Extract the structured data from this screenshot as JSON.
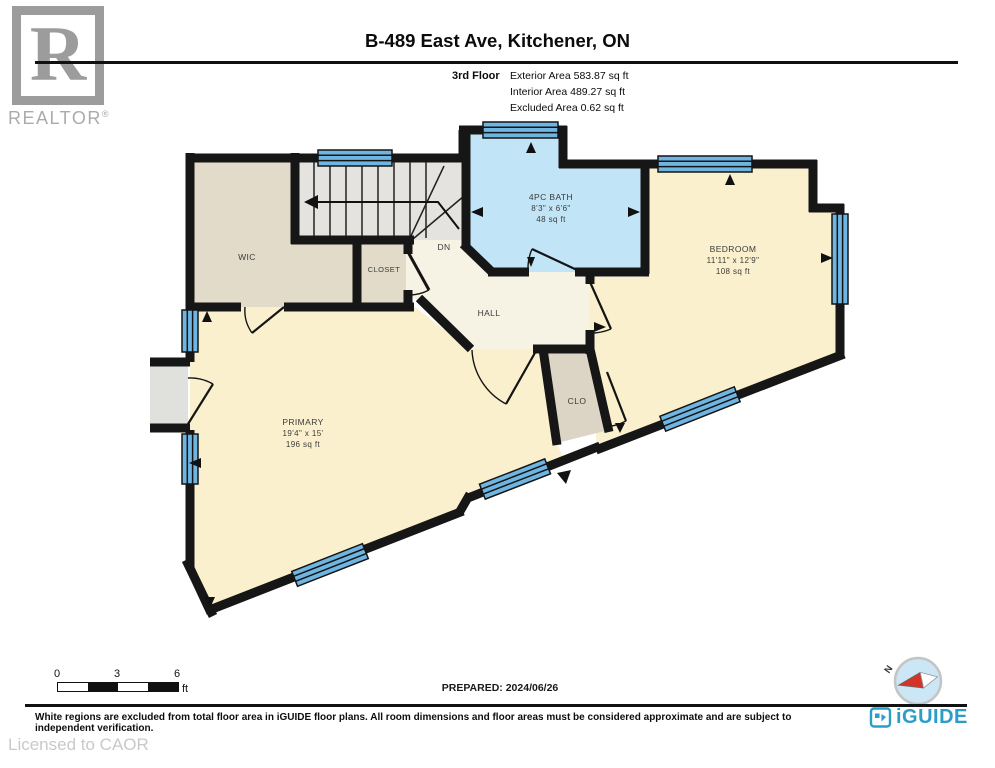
{
  "header": {
    "brand_logo": "R",
    "brand_name": "REALTOR",
    "brand_reg": "®",
    "title": "B-489 East Ave, Kitchener, ON",
    "floor_label": "3rd Floor",
    "area_lines": [
      "Exterior Area 583.87 sq ft",
      "Interior Area 489.27 sq ft",
      "Excluded Area 0.62 sq ft"
    ]
  },
  "plan": {
    "rooms": {
      "wic": {
        "name": "WIC"
      },
      "closet": {
        "name": "CLOSET"
      },
      "stairs": {
        "direction": "DN"
      },
      "bath": {
        "name": "4PC BATH",
        "dims": "8'3\" x 6'6\"",
        "area": "48 sq ft"
      },
      "bedroom": {
        "name": "BEDROOM",
        "dims": "11'11\" x 12'9\"",
        "area": "108 sq ft"
      },
      "hall": {
        "name": "HALL"
      },
      "clo": {
        "name": "CLO"
      },
      "primary": {
        "name": "PRIMARY",
        "dims": "19'4\" x 15'",
        "area": "196 sq ft"
      }
    },
    "colors": {
      "wall": "#161616",
      "room_cream": "#FAF0CD",
      "room_tan": "#E2DBC9",
      "stairs_gray": "#E4E3DF",
      "hall_cream": "#F7F3E4",
      "clo_gray": "#DCD5C5",
      "bath_blue": "#C1E4F7",
      "window_blue": "#6FB5E2",
      "nook_gray": "#E0E0DC"
    }
  },
  "footer": {
    "scale_bar": {
      "ticks": [
        "0",
        "3",
        "6"
      ],
      "unit": "ft"
    },
    "prepared": "PREPARED: 2024/06/26",
    "compass": {
      "north_label": "N"
    },
    "disclaimer": "White regions are excluded from total floor area in iGUIDE floor plans. All room dimensions and floor areas must be considered approximate and are subject to independent verification.",
    "brand": "iGUIDE",
    "license": "Licensed to CAOR"
  }
}
